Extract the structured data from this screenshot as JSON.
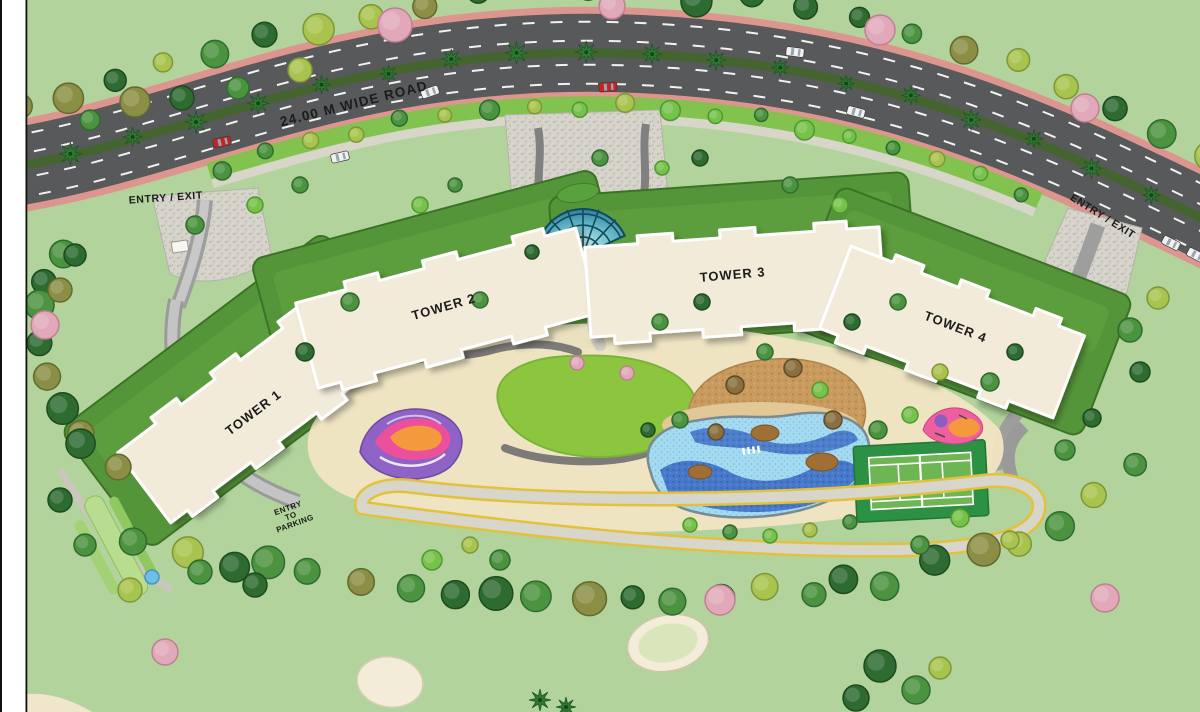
{
  "plan": {
    "road_label": "24.00 M WIDE ROAD",
    "entry_exit_left": "ENTRY / EXIT",
    "entry_exit_right": "ENTRY / EXIT",
    "towers": {
      "t1": "TOWER 1",
      "t2": "TOWER 2",
      "t3": "TOWER 3",
      "t4": "TOWER 4"
    },
    "parking": {
      "l1": "ENTRY",
      "l2": "TO",
      "l3": "PARKING"
    },
    "colors": {
      "grass_bg": "#b2d49c",
      "road_gray": "#58595a",
      "sidewalk_pink": "#dd968f",
      "median_green": "#44652f",
      "tower_beige": "#f3ebd9",
      "podium_green": "#55953a",
      "lawn_green": "#8cc63f",
      "deck_cream": "#f0e4c4",
      "pool_light": "#a6daf0",
      "pool_deep": "#3f6fc6",
      "tennis_green": "#2d9144",
      "track_yellow": "#e2c23c",
      "stone_gray": "#d7d4cb",
      "tan_area": "#c99a5e",
      "shell_teal": "#4aa6b8"
    },
    "icons": {
      "tree": "tree-icon",
      "palm": "palm-icon",
      "car": "car-icon"
    }
  }
}
